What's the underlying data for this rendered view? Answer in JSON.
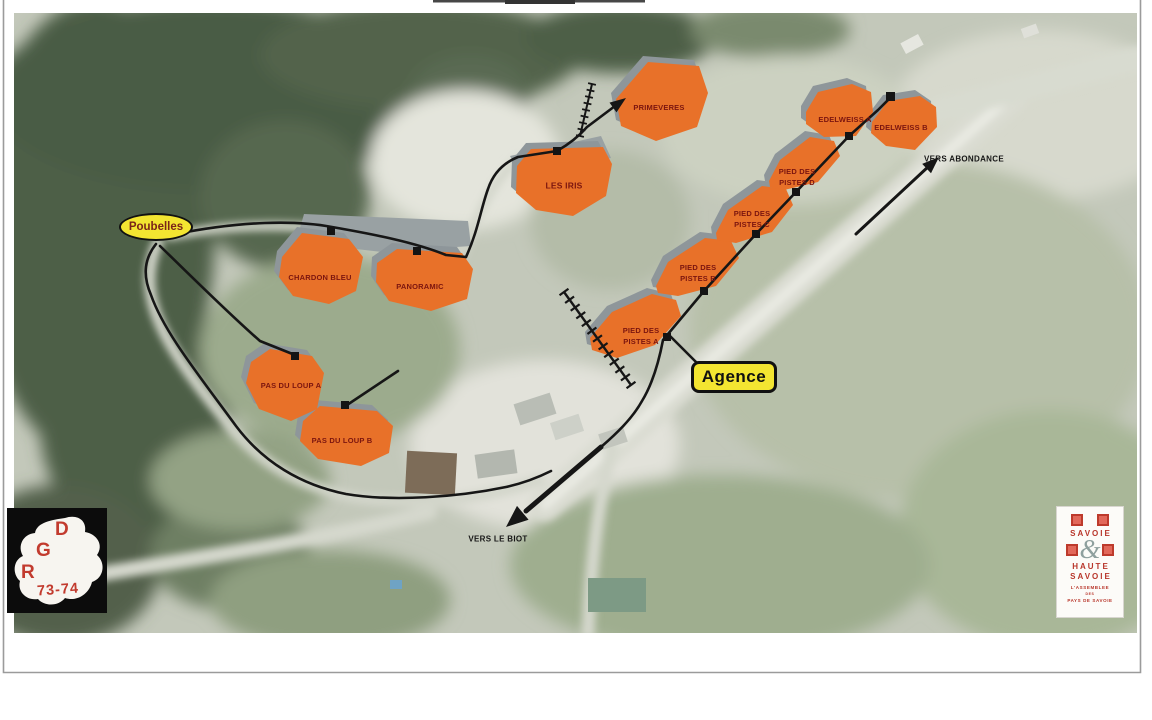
{
  "map": {
    "buildings": [
      {
        "id": "primeveres",
        "label": "PRIMEVERES"
      },
      {
        "id": "les-iris",
        "label": "LES IRIS"
      },
      {
        "id": "chardon-bleu",
        "label": "CHARDON BLEU"
      },
      {
        "id": "panoramic",
        "label": "PANORAMIC"
      },
      {
        "id": "pas-du-loup-a",
        "label": "PAS DU LOUP A"
      },
      {
        "id": "pas-du-loup-b",
        "label": "PAS DU LOUP B"
      },
      {
        "id": "pied-des-pistes-a",
        "label": "PIED DES PISTES A",
        "line1": "PIED DES",
        "line2": "PISTES A"
      },
      {
        "id": "pied-des-pistes-b",
        "label": "PIED DES PISTES B",
        "line1": "PIED DES",
        "line2": "PISTES B"
      },
      {
        "id": "pied-des-pistes-c",
        "label": "PIED DES PISTES C",
        "line1": "PIED DES",
        "line2": "PISTES C"
      },
      {
        "id": "pied-des-pistes-d",
        "label": "PIED DES PISTES D",
        "line1": "PIED DES",
        "line2": "PISTES D"
      },
      {
        "id": "edelweiss-a",
        "label": "EDELWEISS A"
      },
      {
        "id": "edelweiss-b",
        "label": "EDELWEISS B"
      }
    ],
    "callouts": {
      "poubelles": "Poubelles",
      "agence": "Agence"
    },
    "directions": {
      "abondance": "VERS ABONDANCE",
      "le_biot": "VERS LE BIOT"
    },
    "colors": {
      "building_fill": "#e87129",
      "building_label": "#7b150f",
      "highlight_yellow": "#f3e531",
      "annotation_black": "#161616",
      "logo_red": "#c23b2e"
    }
  },
  "logos": {
    "dgr": {
      "d": "D",
      "g": "G",
      "r": "R",
      "code": "73-74"
    },
    "savoie": {
      "word1": "SAVOIE",
      "ampersand": "&",
      "word2": "HAUTE",
      "word3": "SAVOIE",
      "sub1": "L'ASSEMBLEE",
      "sub2": "DES",
      "sub3": "PAYS DE SAVOIE"
    }
  }
}
